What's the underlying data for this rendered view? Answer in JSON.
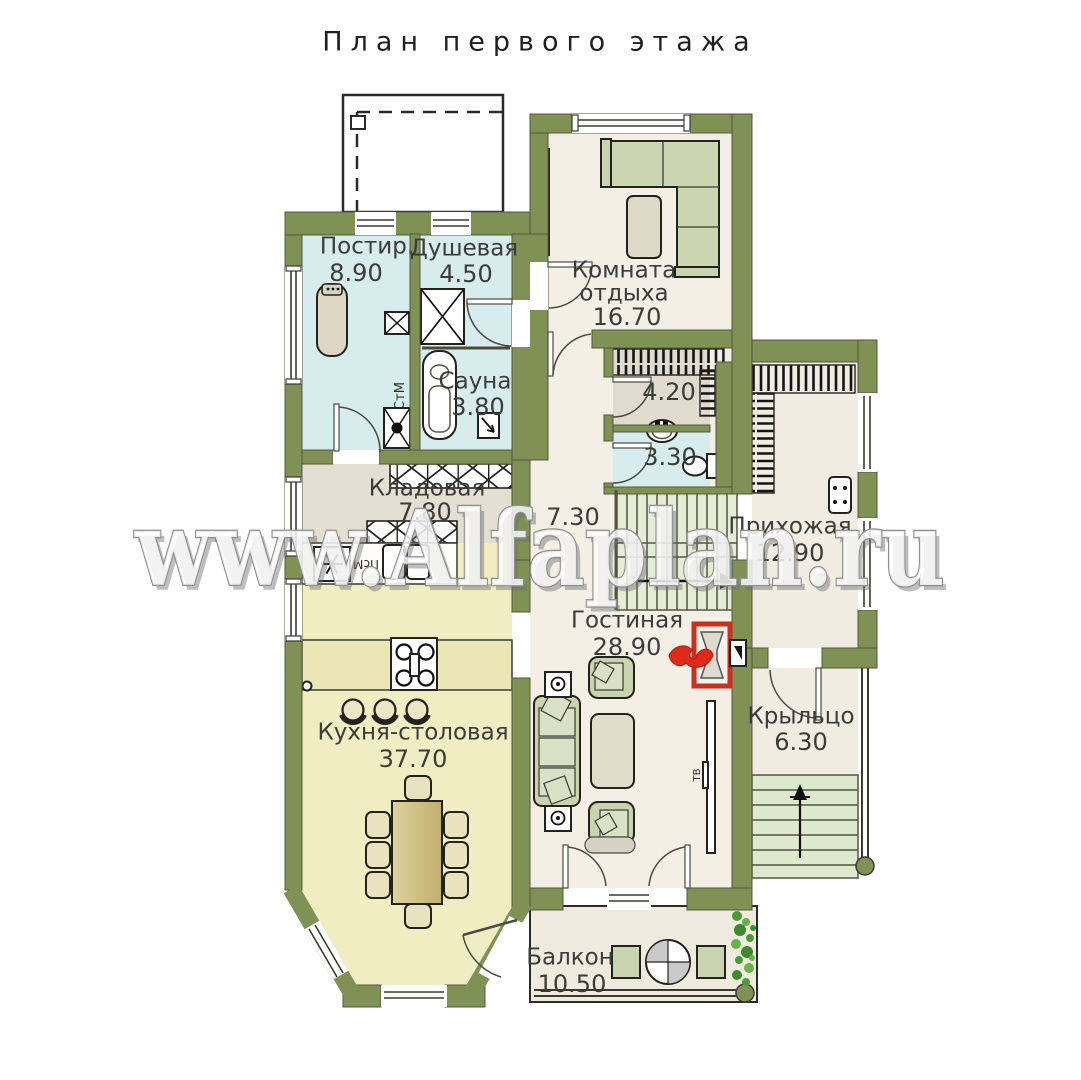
{
  "title": "План первого этажа",
  "watermark": "www.Alfaplan.ru",
  "rooms": {
    "laundry": {
      "name": "Постир.",
      "area": "8.90"
    },
    "shower": {
      "name": "Душевая",
      "area": "4.50"
    },
    "sauna": {
      "name": "Сауна",
      "area": "3.80"
    },
    "lounge": {
      "line1": "Комната",
      "line2": "отдыха",
      "area": "16.70"
    },
    "wardrobe": {
      "area": "4.20"
    },
    "wc": {
      "area": "3.30"
    },
    "storage": {
      "name": "Кладовая",
      "area": "7.80"
    },
    "corridor": {
      "area": "7.30"
    },
    "hallway": {
      "name": "Прихожая",
      "area": "12.90"
    },
    "living": {
      "name": "Гостиная",
      "area": "28.90"
    },
    "kitchen": {
      "name": "Кухня-столовая",
      "area": "37.70"
    },
    "porch": {
      "name": "Крыльцо",
      "area": "6.30"
    },
    "balcony": {
      "name": "Балкон",
      "area": "10.50"
    }
  },
  "appliances": {
    "washer": "СтМ",
    "dishwasher": "ПсМ",
    "tv": "ТВ"
  },
  "colors": {
    "wall": "#7f9155",
    "wet_floor": "#d7eded",
    "kitchen_floor": "#f1edc3",
    "floor": "#f3efe5",
    "storage_floor": "#e3dfd2",
    "step_green": "#dde8cc",
    "fireplace_red": "#c8301f",
    "plant_green": "#4c9a35",
    "furniture_green": "#c9d3b0",
    "table_beige": "#d5c58b"
  }
}
